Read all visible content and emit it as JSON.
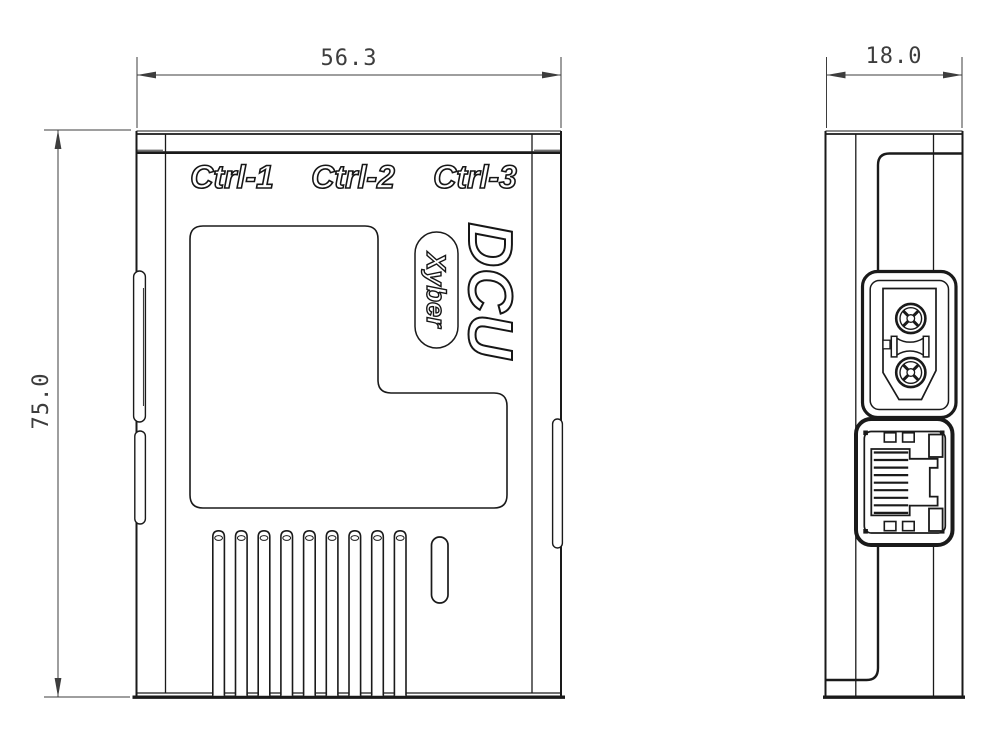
{
  "dimensions": {
    "front_width_mm": "56.3",
    "front_height_mm": "75.0",
    "side_depth_mm": "18.0"
  },
  "labels": {
    "port1": "Ctrl-1",
    "port2": "Ctrl-2",
    "port3": "Ctrl-3",
    "model": "DCU",
    "brand": "Xyber"
  },
  "icons": {
    "power_connector": "xt30-power-connector-icon",
    "ethernet_port": "rj45-ethernet-port-icon",
    "vents": "cooling-fins-icon"
  },
  "colors": {
    "line": "#1a1a1a",
    "dimension": "#3d3d3d",
    "background": "#ffffff"
  }
}
